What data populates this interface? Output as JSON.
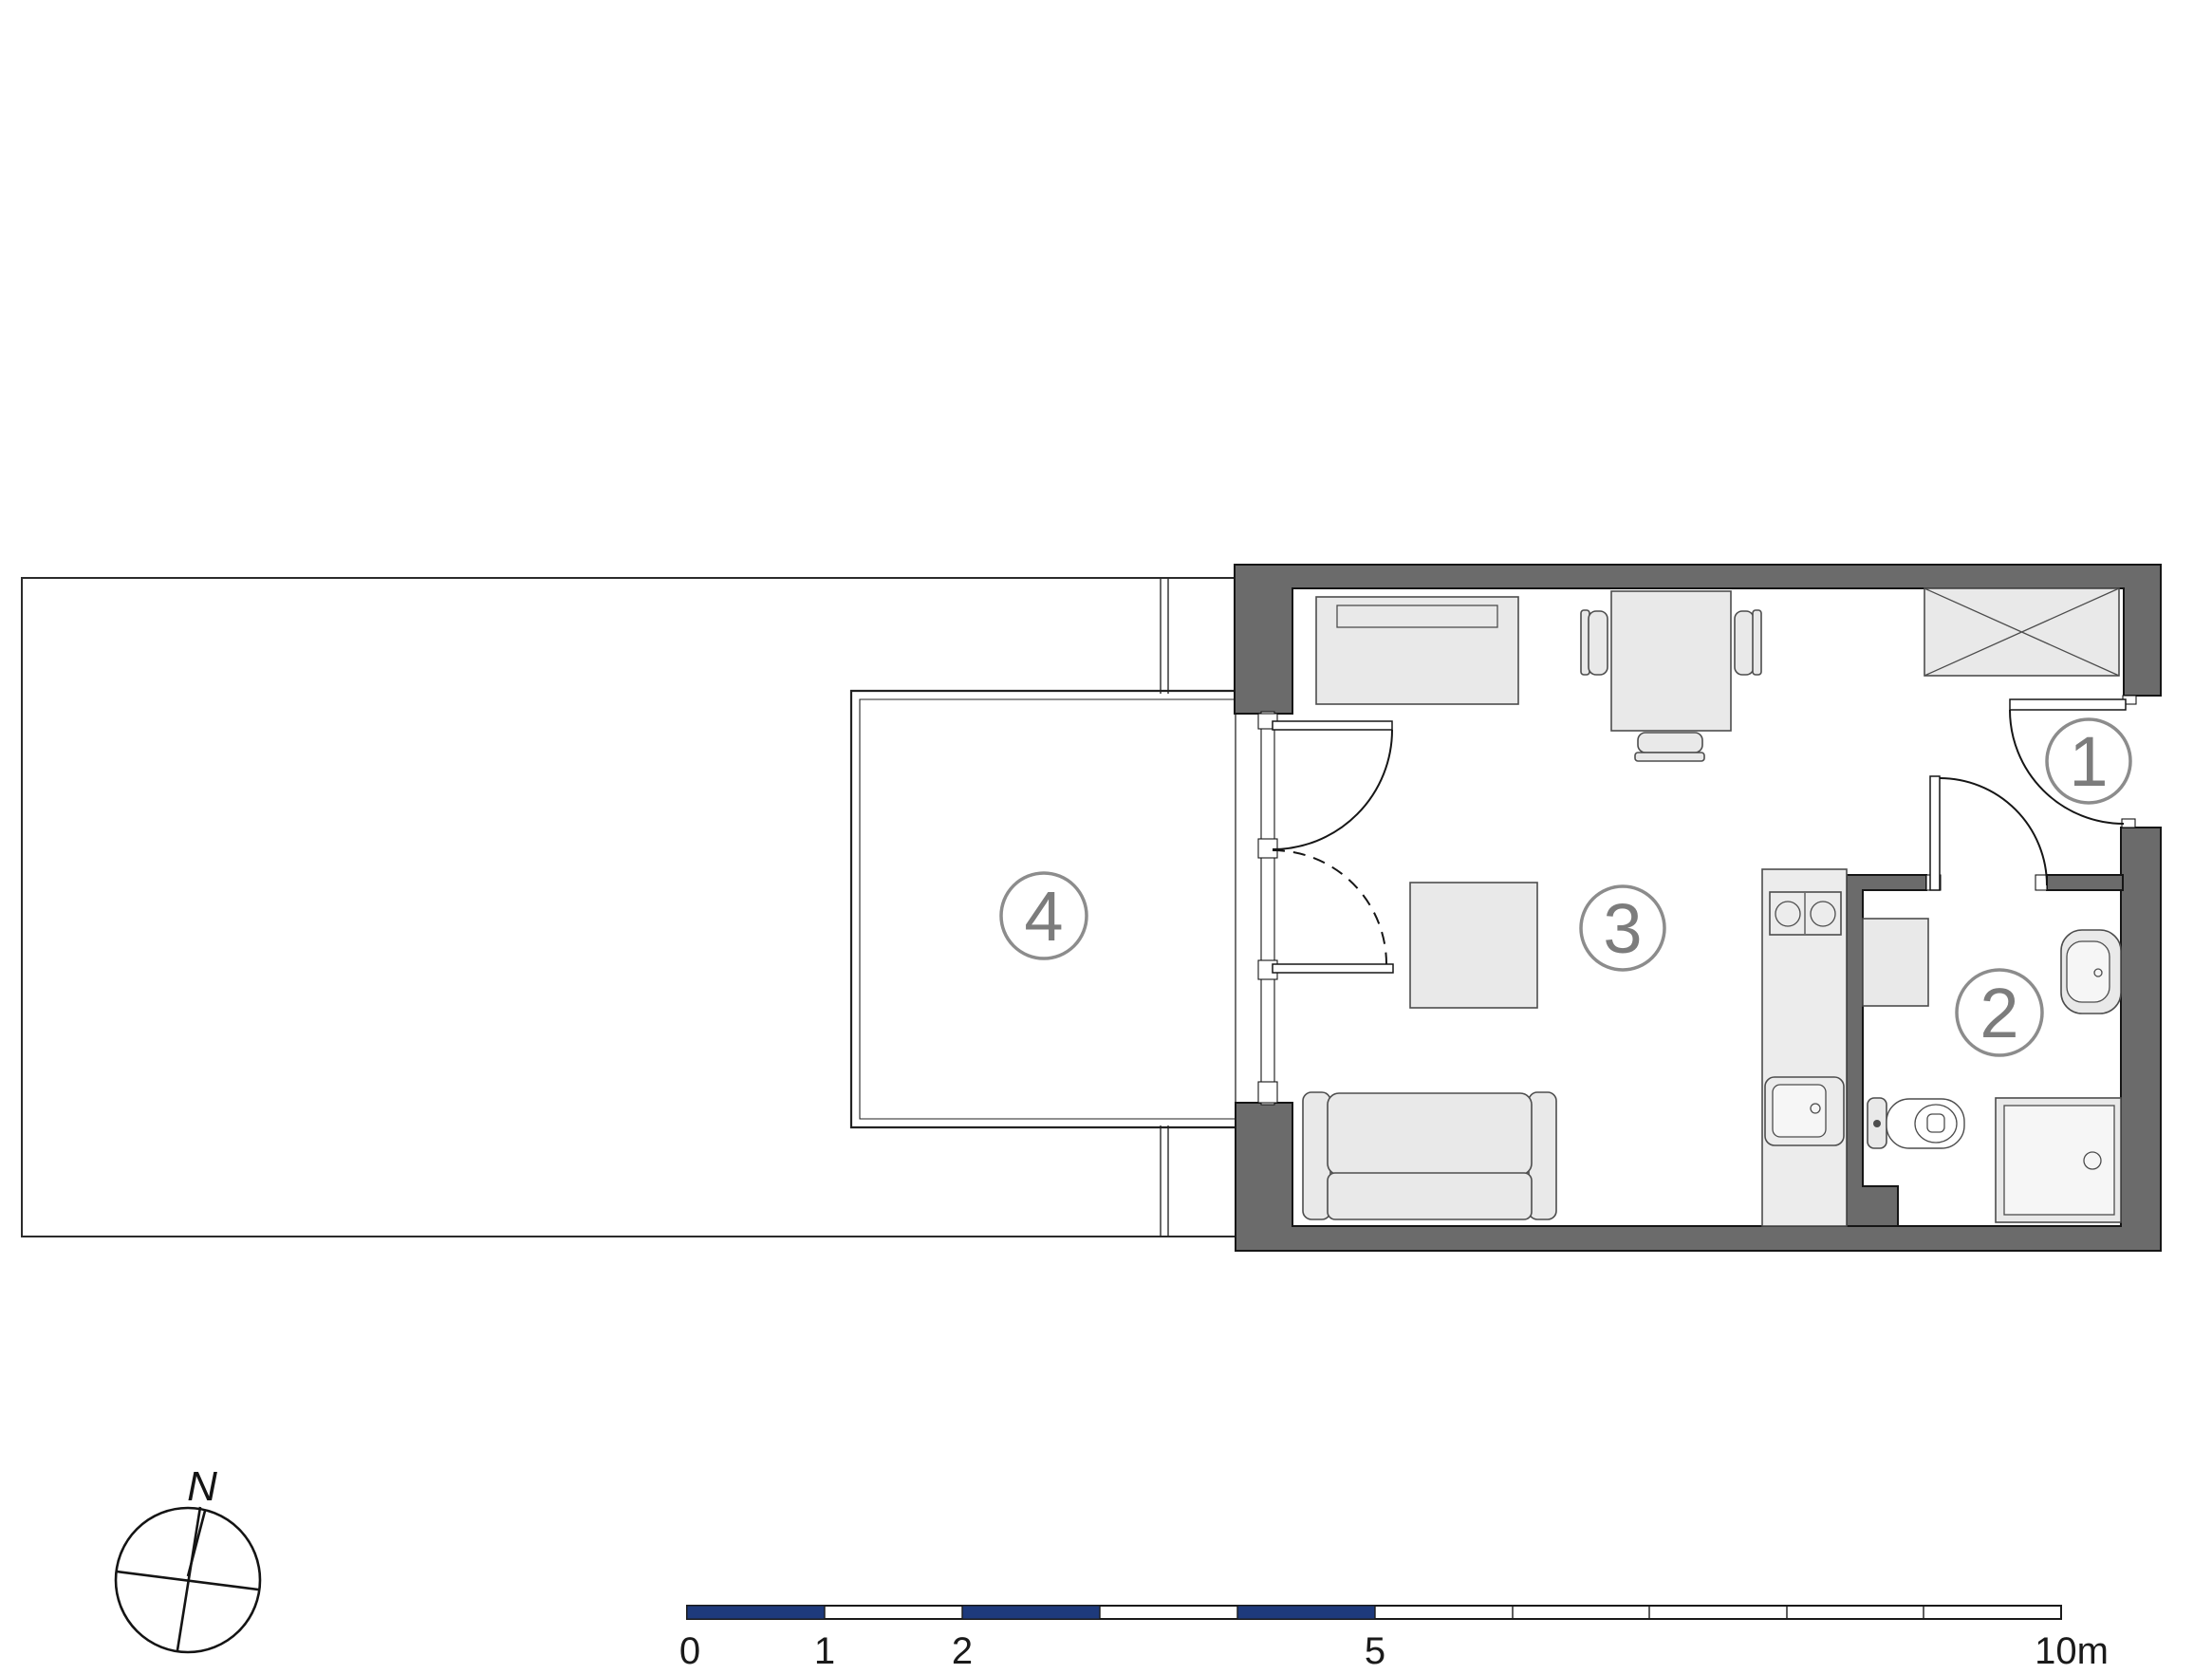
{
  "title": "Studio apartment floor plan with terrace",
  "colors": {
    "background": "#ffffff",
    "wall_fill": "#6b6b6b",
    "wall_outline": "#161616",
    "furniture_fill": "#e9e9e9",
    "furniture_stroke": "#4d4d4d",
    "room_circle_stroke": "#8c8c8c",
    "room_number_text": "#7c7c7c",
    "scale_bar_blue": "#1e3a7c",
    "scale_bar_text": "#1a1a1a"
  },
  "rooms": [
    {
      "label": "1"
    },
    {
      "label": "2"
    },
    {
      "label": "3"
    },
    {
      "label": "4"
    }
  ],
  "compass": {
    "north_label": "N"
  },
  "scale_bar": {
    "unit": "m",
    "tick_labels": [
      {
        "text": "0"
      },
      {
        "text": "1"
      },
      {
        "text": "2"
      },
      {
        "text": "5"
      },
      {
        "text": "10m"
      }
    ]
  }
}
